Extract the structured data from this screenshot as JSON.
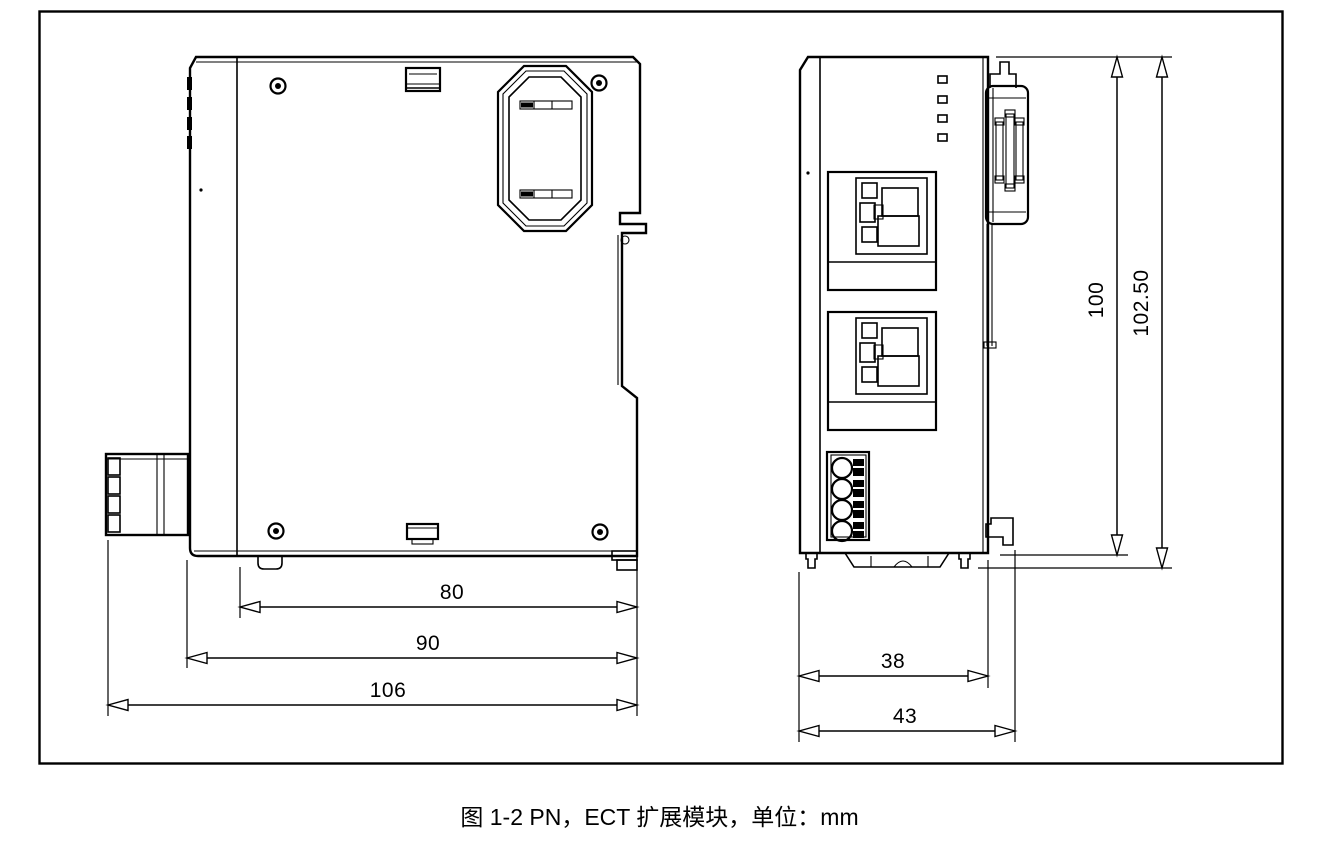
{
  "caption": "图 1-2 PN，ECT 扩展模块，单位：mm",
  "dimensions": {
    "side_view": {
      "d80": "80",
      "d90": "90",
      "d106": "106"
    },
    "front_view": {
      "d38": "38",
      "d43": "43",
      "d100": "100",
      "d102_50": "102.50"
    }
  }
}
